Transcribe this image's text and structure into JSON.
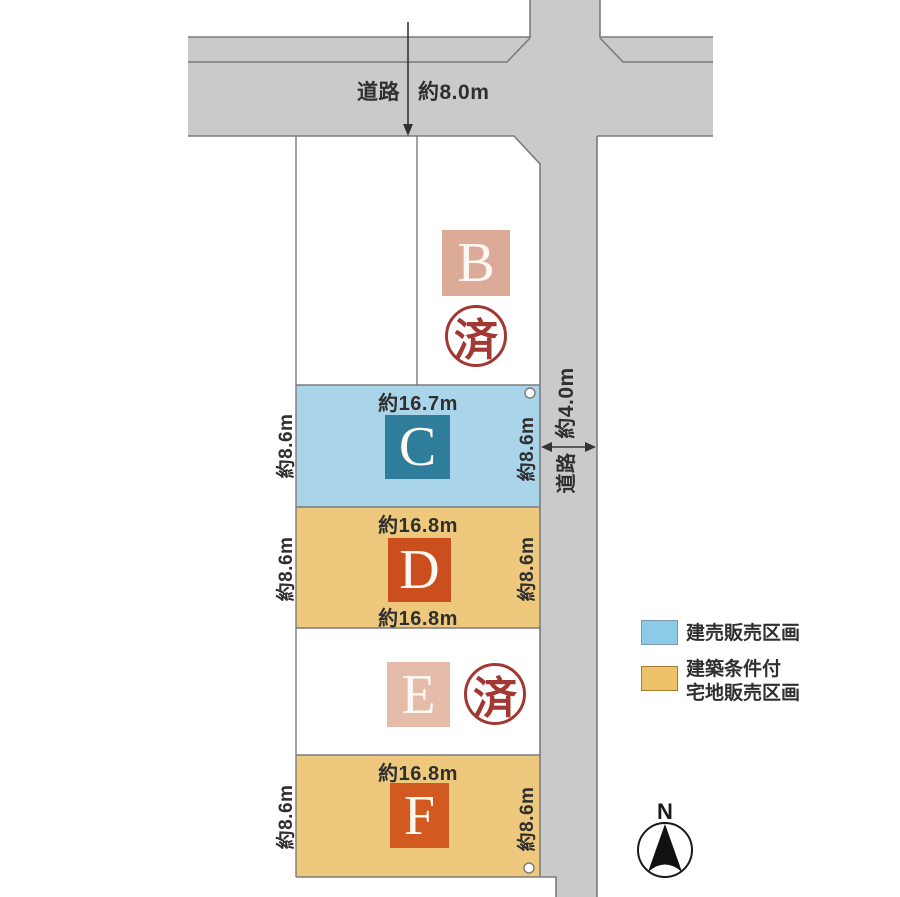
{
  "diagram": {
    "road_top": {
      "name": "道路",
      "width": "約8.0m"
    },
    "road_right": {
      "name": "道路",
      "width": "約4.0m"
    },
    "lots": {
      "b": {
        "letter": "B",
        "stamp": "済"
      },
      "c": {
        "letter": "C",
        "dim_top": "約16.7m",
        "dim_left": "約8.6m",
        "dim_right": "約8.6m"
      },
      "d": {
        "letter": "D",
        "dim_top": "約16.8m",
        "dim_bottom": "約16.8m",
        "dim_left": "約8.6m",
        "dim_right": "約8.6m"
      },
      "e": {
        "letter": "E",
        "stamp": "済"
      },
      "f": {
        "letter": "F",
        "dim_top": "約16.8m",
        "dim_left": "約8.6m",
        "dim_right": "約8.6m"
      }
    },
    "legend": {
      "item1": {
        "label": "建売販売区画",
        "color": "#8dcae8"
      },
      "item2": {
        "label_line1": "建築条件付",
        "label_line2": "宅地販売区画",
        "color": "#eec26b"
      }
    },
    "compass": {
      "label": "N"
    },
    "colors": {
      "road_fill": "#cacaca",
      "road_line": "#7b7b7b",
      "lot_c_fill": "#aad4e9",
      "lot_tan_fill": "#edc87d",
      "badge_b": "#dcab98",
      "badge_c": "#2e7e9b",
      "badge_d": "#ca4e1e",
      "badge_e": "#e5bbaa",
      "badge_f": "#d2591f",
      "stamp_red": "#a23833"
    }
  }
}
